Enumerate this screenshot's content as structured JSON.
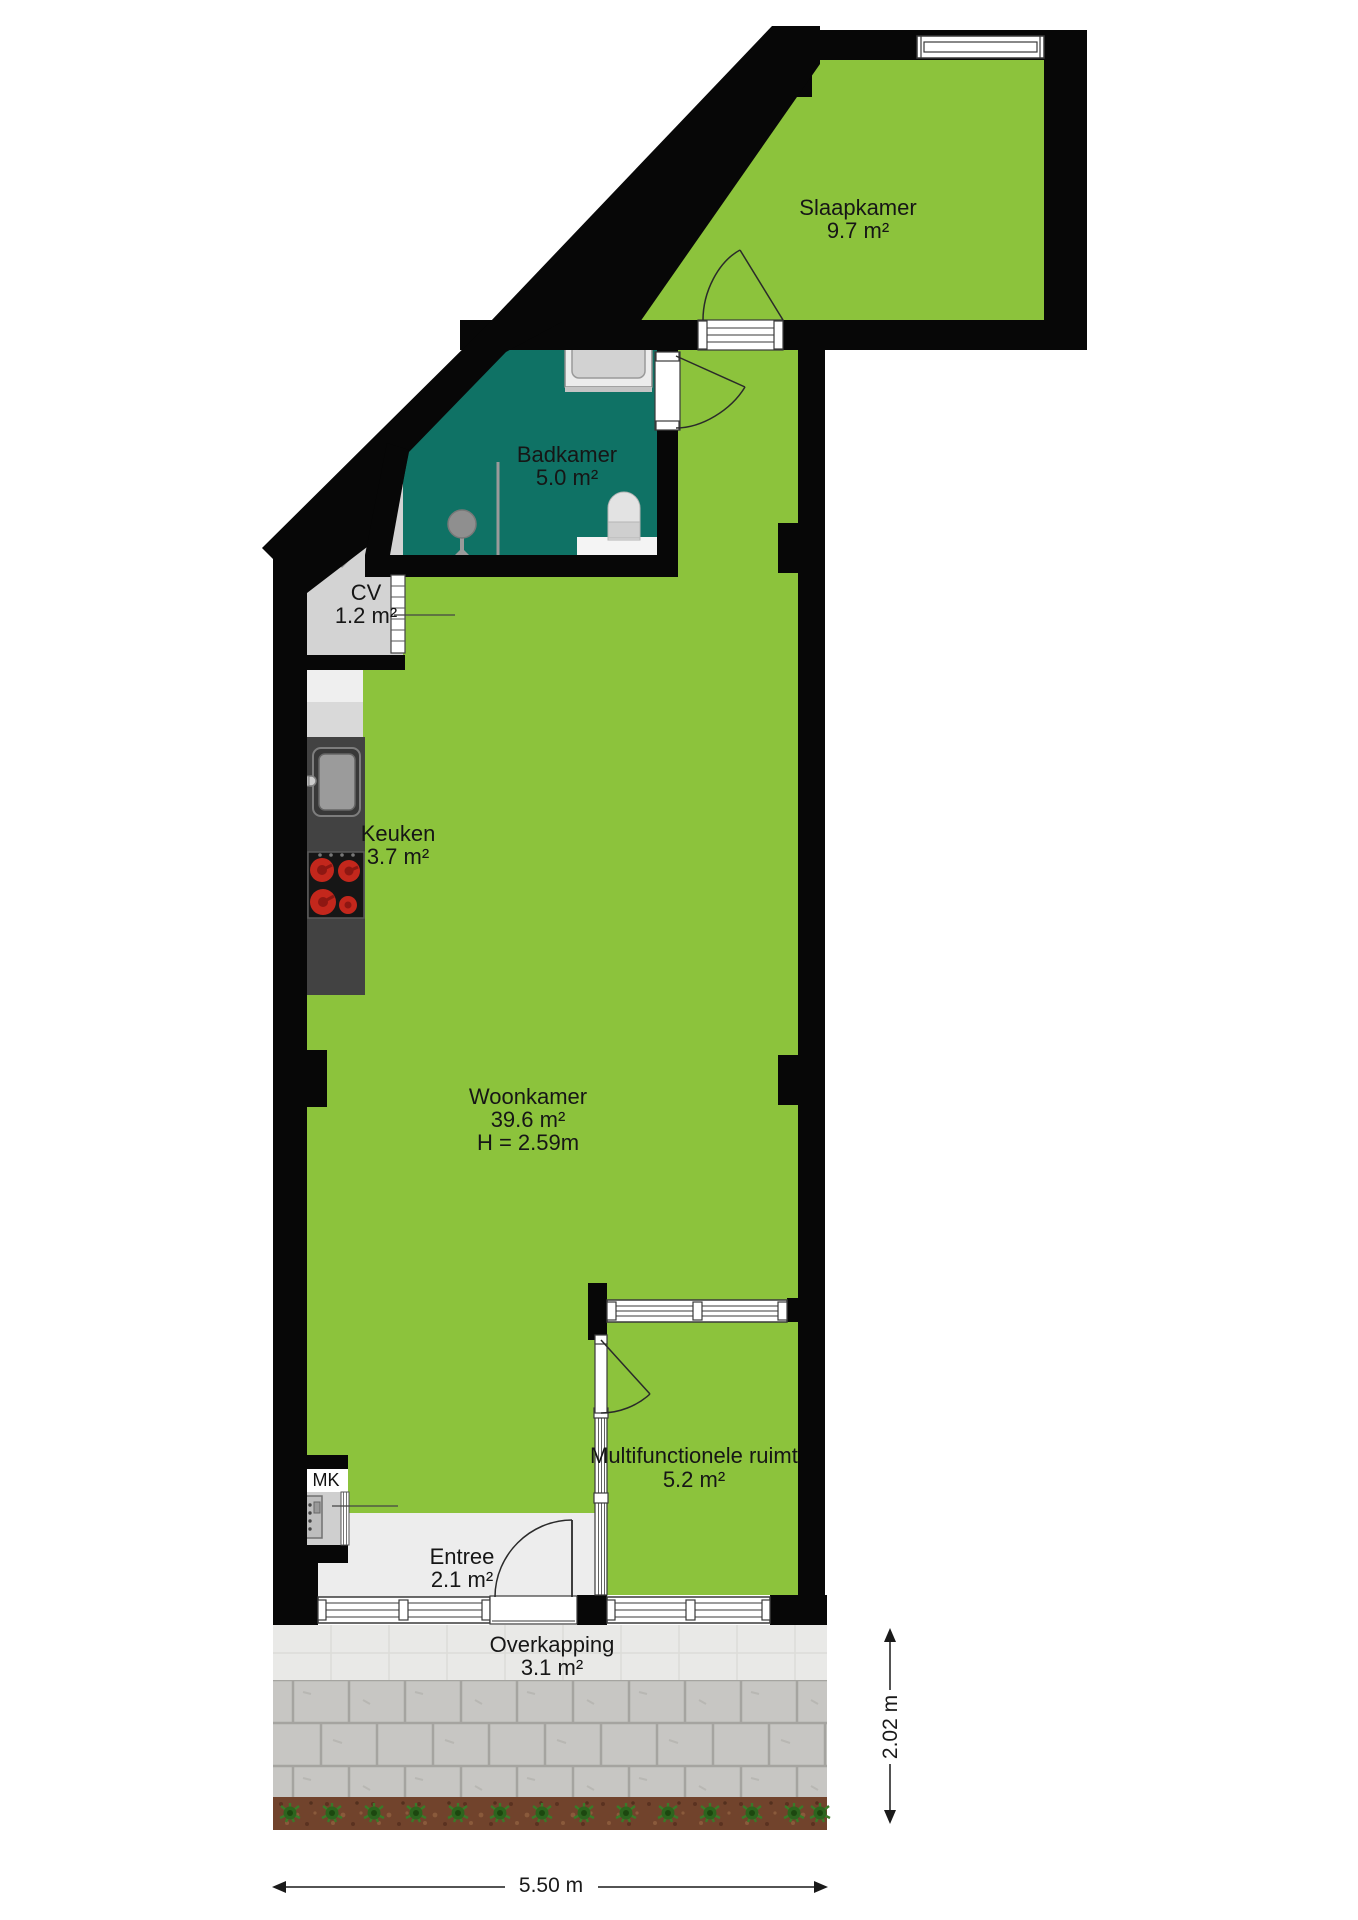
{
  "plan_title": "Appartement plattegrond",
  "rooms": {
    "slaapkamer": {
      "label": "Slaapkamer",
      "area": "9.7 m²"
    },
    "badkamer": {
      "label": "Badkamer",
      "area": "5.0 m²"
    },
    "cv": {
      "label": "CV",
      "area": "1.2 m²"
    },
    "keuken": {
      "label": "Keuken",
      "area": "3.7 m²"
    },
    "woonkamer": {
      "label": "Woonkamer",
      "area": "39.6 m²",
      "ceiling_height": "H = 2.59m"
    },
    "multifunctionele_ruimte": {
      "label": "Multifunctionele ruimte",
      "area": "5.2 m²"
    },
    "entree": {
      "label": "Entree",
      "area": "2.1 m²"
    },
    "overkapping": {
      "label": "Overkapping",
      "area": "3.1 m²"
    },
    "meterkast": {
      "label": "MK"
    }
  },
  "dimensions": {
    "bottom_width": "5.50 m",
    "right_depth": "2.02 m"
  },
  "colors": {
    "floor_green": "#8cc33c",
    "bathroom_teal": "#0f7265",
    "wall_black": "#070707",
    "closet_gray": "#d3d3d3",
    "entree_gray": "#ededed",
    "counter_dark": "#424242",
    "burner_red": "#c3271c",
    "paver_gray": "#c7c6c3",
    "soil_brown": "#71432c",
    "plant_green": "#2d641e"
  },
  "icons": {
    "boiler": "flame-icon",
    "stove": "stove-icon",
    "kitchen_sink": "sink-icon",
    "bath_sink": "pedestal-sink-icon",
    "toilet": "toilet-icon",
    "bathtub": "bathtub-icon",
    "meter": "electric-meter-icon",
    "dimension_arrows": "arrow-icon"
  }
}
